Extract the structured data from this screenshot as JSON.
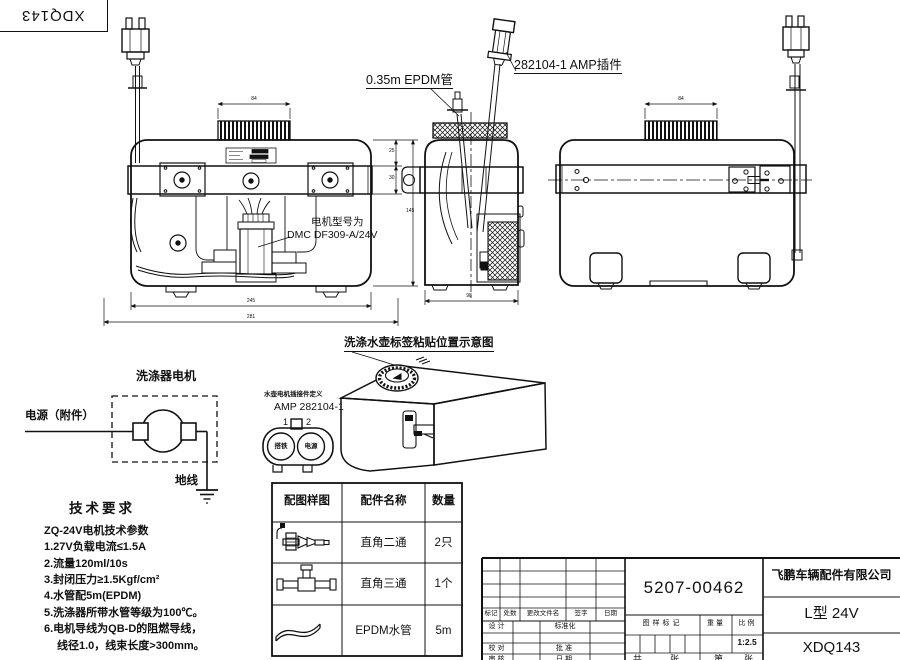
{
  "page": {
    "background": "#ffffff",
    "ink": "#111111"
  },
  "corner": {
    "code": "XDQ143"
  },
  "annotations": {
    "epdm_tube": "0.35m EPDM管",
    "amp_plug": "282104-1  AMP插件",
    "motor_model_label": "电机型号为",
    "motor_model_value": "DMC DF309-A/24V",
    "tank_label_caption": "洗涤水壶标签粘贴位置示意图"
  },
  "dims": {
    "front_inner": "245",
    "front_outer": "281",
    "side_width": "98",
    "cap_front": "84",
    "cap_right": "84",
    "bracket_top": "25",
    "bracket_band": "30",
    "body_height": "145"
  },
  "circuit": {
    "title": "洗涤器电机",
    "power_label": "电源（附件）",
    "ground_label": "地线"
  },
  "connector_detail": {
    "definition": "水壶电机插接件定义",
    "model": "AMP 282104-1",
    "pin1": "1",
    "pin2": "2",
    "pin1_name": "搭铁",
    "pin2_name": "电源"
  },
  "tech": {
    "title": "技术要求",
    "lines": [
      "ZQ-24V电机技术参数",
      "1.27V负载电流≤1.5A",
      "2.流量120ml/10s",
      "3.封闭压力≥1.5Kgf/cm²",
      "4.水管配5m(EPDM)",
      "5.洗涤器所带水管等级为100℃。",
      "6.电机导线为QB-D的阻燃导线，",
      "线径1.0，线束长度>300mm。"
    ]
  },
  "parts_table": {
    "headers": [
      "配图样图",
      "配件名称",
      "数量"
    ],
    "rows": [
      {
        "icon": "elbow-fitting",
        "name": "直角二通",
        "qty": "2只"
      },
      {
        "icon": "tee-fitting",
        "name": "直角三通",
        "qty": "1个"
      },
      {
        "icon": "hose",
        "name": "EPDM水管",
        "qty": "5m"
      }
    ]
  },
  "title_block": {
    "part_number": "5207-00462",
    "company": "飞鹏车辆配件有限公司",
    "model": "L型 24V",
    "code": "XDQ143",
    "scale": "1:2.5",
    "rev_cols": [
      "标记",
      "处数",
      "更改文件名",
      "签字",
      "日期"
    ],
    "design": "设计",
    "standardize": "标准化",
    "check": "校对",
    "approve": "批准",
    "review": "审核",
    "date": "日期",
    "mark": "图样标记",
    "weight": "重量",
    "scale_label": "比例",
    "sheet_a": "共",
    "sheet_b": "张",
    "sheet_c": "第",
    "sheet_d": "张"
  }
}
